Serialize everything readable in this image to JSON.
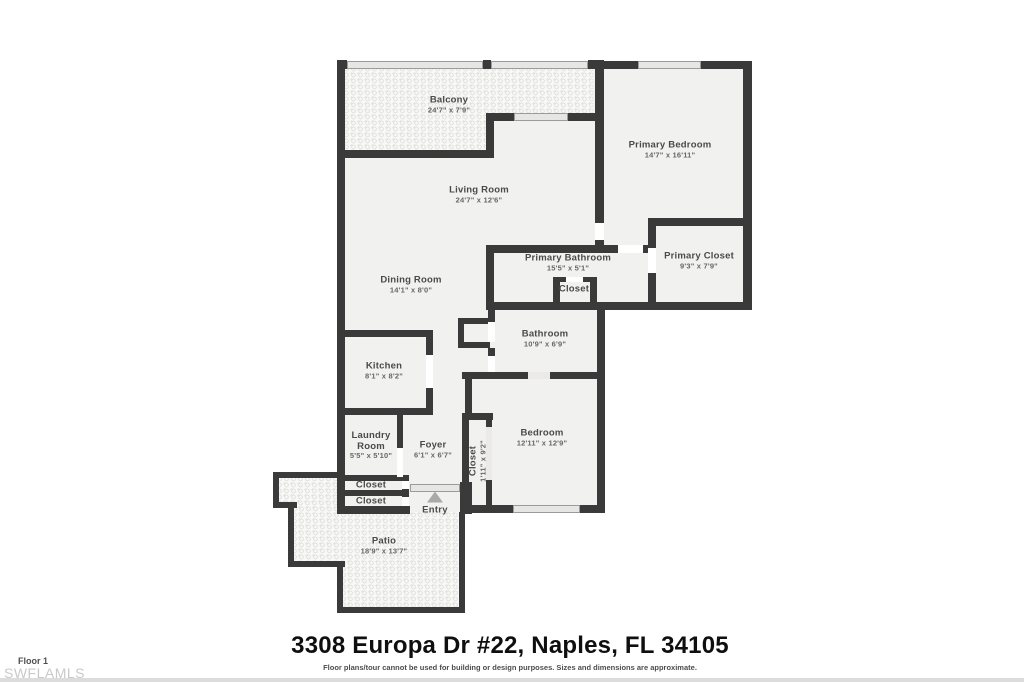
{
  "plan": {
    "rooms": [
      {
        "name": "Balcony",
        "dims": "24'7\" x 7'9\""
      },
      {
        "name": "Primary Bedroom",
        "dims": "14'7\" x 16'11\""
      },
      {
        "name": "Living Room",
        "dims": "24'7\" x 12'6\""
      },
      {
        "name": "Primary Bathroom",
        "dims": "15'5\" x 5'1\""
      },
      {
        "name": "Primary Closet",
        "dims": "9'3\" x 7'9\""
      },
      {
        "name": "Closet",
        "dims": ""
      },
      {
        "name": "Dining Room",
        "dims": "14'1\" x 8'0\""
      },
      {
        "name": "Bathroom",
        "dims": "10'9\" x 6'9\""
      },
      {
        "name": "Kitchen",
        "dims": "8'1\" x 8'2\""
      },
      {
        "name": "Laundry Room",
        "dims": "5'5\" x 5'10\""
      },
      {
        "name": "Foyer",
        "dims": "6'1\" x 6'7\""
      },
      {
        "name": "Closet",
        "dims": "1'11\" x 9'2\""
      },
      {
        "name": "Bedroom",
        "dims": "12'11\" x 12'9\""
      },
      {
        "name": "Closet",
        "dims": ""
      },
      {
        "name": "Closet",
        "dims": ""
      },
      {
        "name": "Patio",
        "dims": "18'9\" x 13'7\""
      }
    ],
    "entry_label": "Entry"
  },
  "footer": {
    "address": "3308 Europa Dr #22, Naples, FL 34105",
    "disclaimer": "Floor plans/tour cannot be used for building or design purposes. Sizes and dimensions are approximate.",
    "floor_label": "Floor 1",
    "watermark": "SWFLAMLS"
  },
  "colors": {
    "wall": "#3a3a3a",
    "room_fill": "#f1f1ef",
    "hatch_dot": "#e2e2df",
    "window_fill": "#e6e6e4",
    "label_text": "#4a4a4a"
  }
}
